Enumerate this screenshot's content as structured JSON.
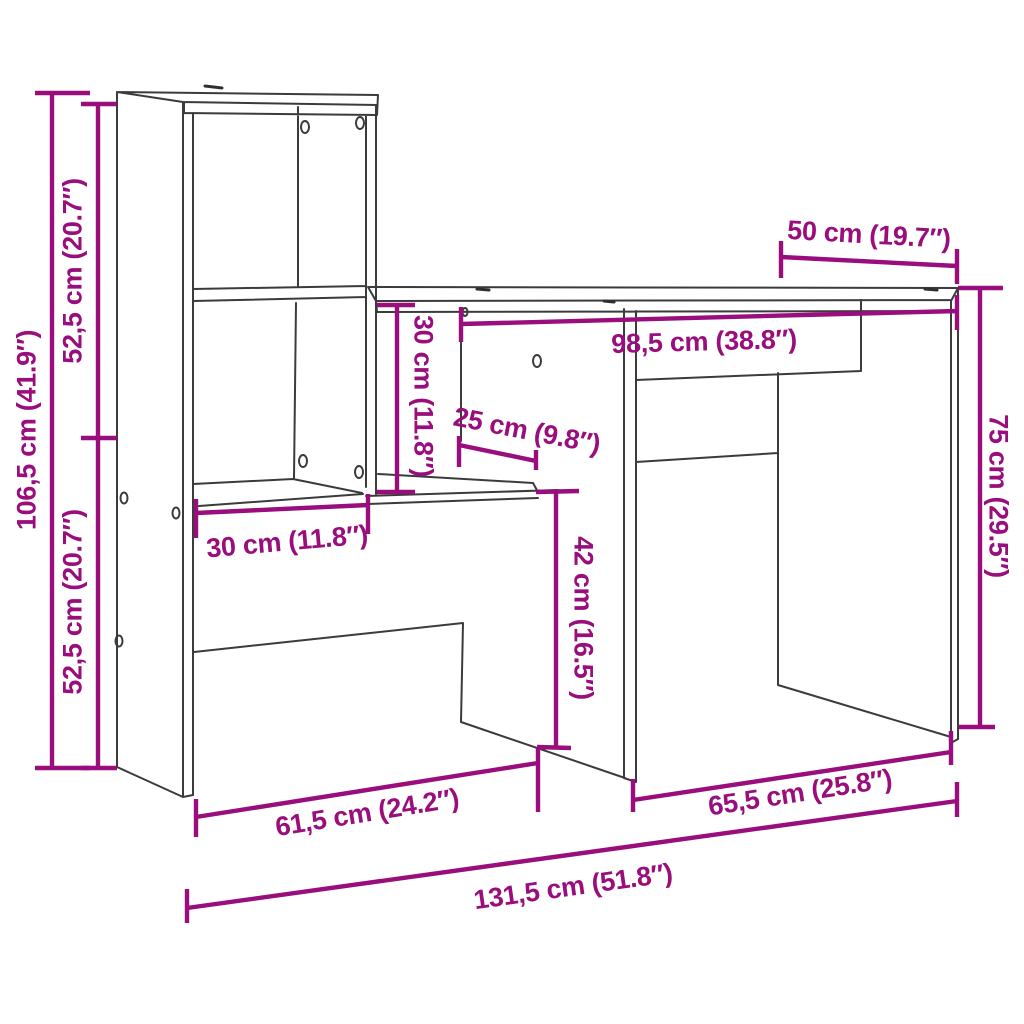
{
  "diagram": {
    "type": "furniture-dimension-drawing",
    "subject": "desk with integrated shelf unit",
    "background": "#ffffff",
    "accent_color": "#990d7c",
    "line_color": "#3b3b3b",
    "dimensions": {
      "total_height": "106,5 cm (41.9″)",
      "upper_section_height": "52,5 cm (20.7″)",
      "lower_section_height": "52,5 cm (20.7″)",
      "desk_depth": "50 cm (19.7″)",
      "desktop_inner_width": "98,5 cm (38.8″)",
      "niche_height": "30 cm (11.8″)",
      "shelf_depth": "25 cm (9.8″)",
      "shelf_width": "30 cm (11.8″)",
      "knee_space_height": "42 cm (16.5″)",
      "desk_height": "75 cm (29.5″)",
      "left_section_floor_width": "61,5 cm (24.2″)",
      "right_section_floor_width": "65,5 cm (25.8″)",
      "total_width": "131,5 cm (51.8″)"
    }
  }
}
